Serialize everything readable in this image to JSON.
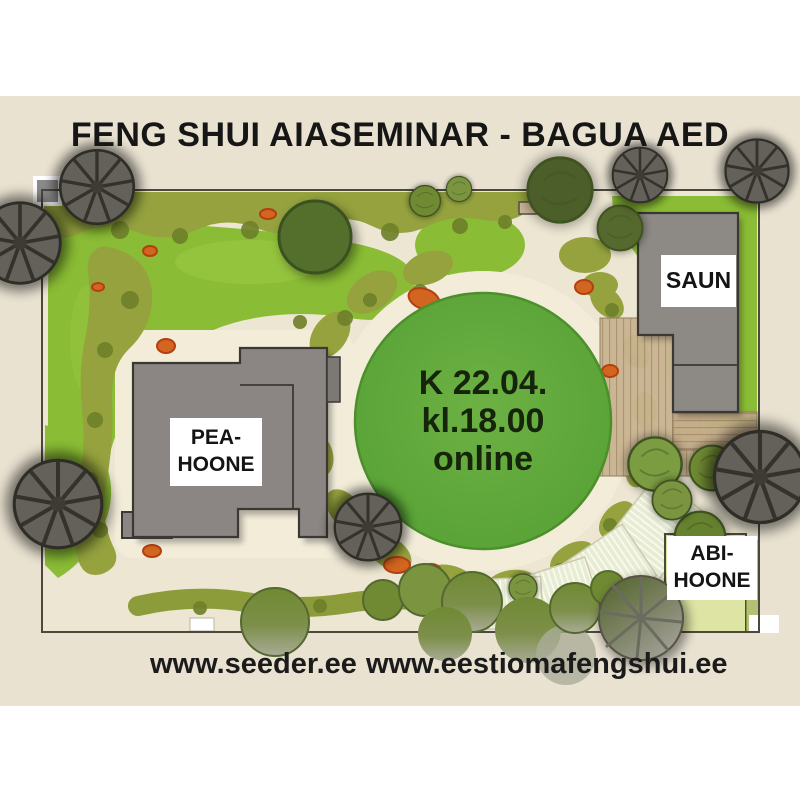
{
  "title": "FENG SHUI AIASEMINAR - BAGUA AED",
  "event_circle": {
    "lines": [
      "K 22.04.",
      "kl.18.00",
      "online"
    ]
  },
  "buildings": {
    "pea_hoone": {
      "label": "PEA-\nHOONE"
    },
    "saun": {
      "label": "SAUN"
    },
    "abi_hoone": {
      "label": "ABI-\nHOONE"
    }
  },
  "footer": {
    "links": [
      "www.seeder.ee",
      "www.eestiomafengshui.ee"
    ]
  },
  "colors": {
    "background_beige": "#e9e2d1",
    "path_cream": "#f2ecd9",
    "lawn_green": "#8abc35",
    "circle_green": "#62a93c",
    "shrub_olive": "#95a23e",
    "building_gray": "#8b8683",
    "deck_tan": "#c9b491",
    "terrace_pale": "#e7edd4",
    "flower_orange": "#d2651f",
    "abi_pale_green": "#dde4a4"
  }
}
